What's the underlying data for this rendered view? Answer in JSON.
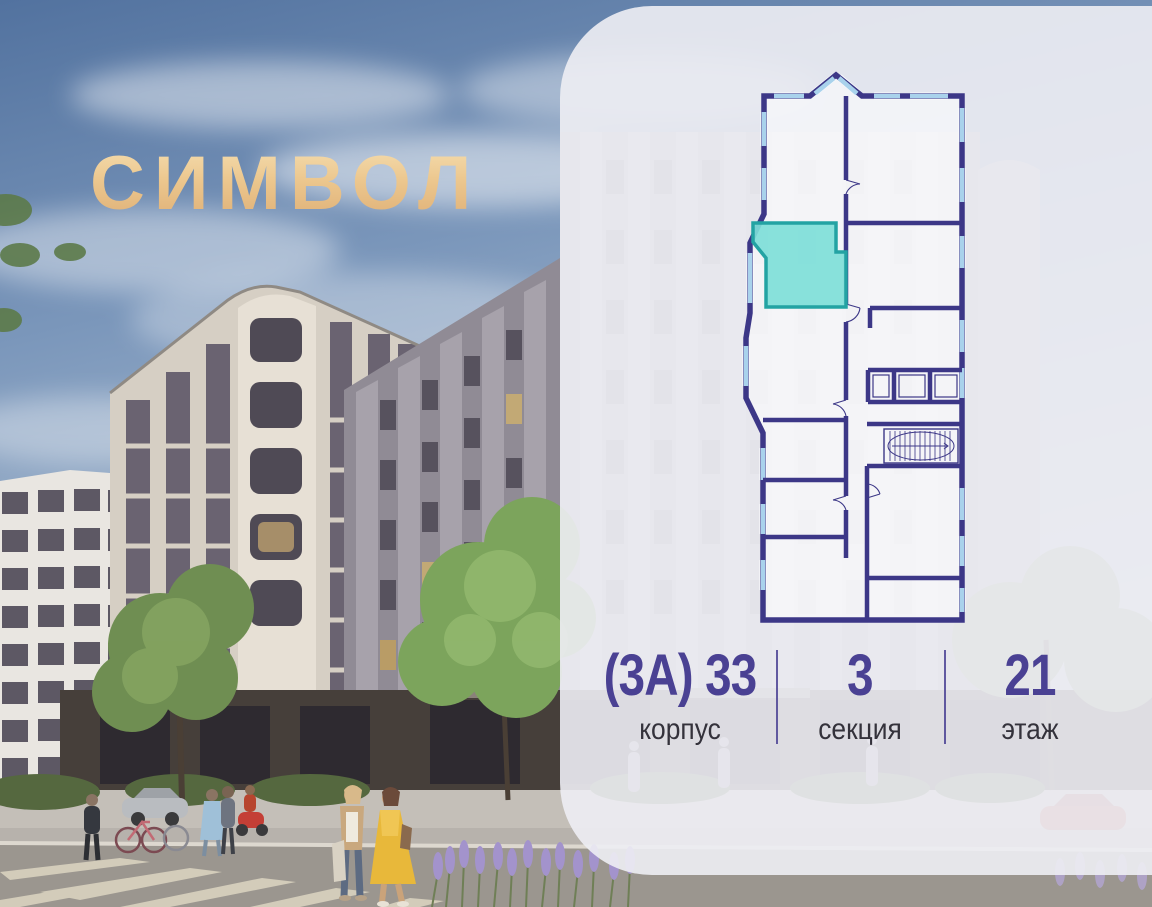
{
  "brand": {
    "logo_text": "СИМВОЛ",
    "logo_color": "#ecc78e"
  },
  "panel": {
    "background": "#ededf3"
  },
  "floor_plan": {
    "name": "section-floor-plan",
    "wall_color": "#3c3787",
    "window_color": "#a9d2ec",
    "highlight_fill": "#7eded8",
    "highlight_border": "#23a3a3",
    "highlighted_unit": "selected-apartment"
  },
  "info": {
    "accent_color": "#4a4193",
    "building": {
      "value": "(3А) 33",
      "label": "корпус"
    },
    "section": {
      "value": "3",
      "label": "секция"
    },
    "floor": {
      "value": "21",
      "label": "этаж"
    }
  }
}
